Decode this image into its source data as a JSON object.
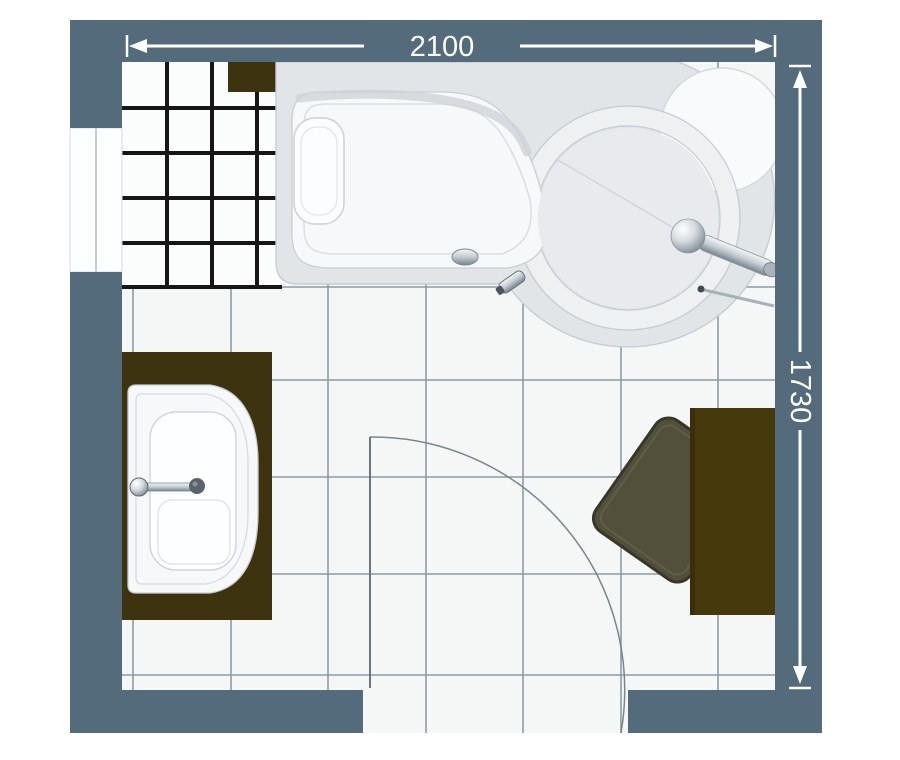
{
  "title": "Bathroom floor plan",
  "dimensions": {
    "width_label": "2100",
    "height_label": "1730"
  },
  "colors": {
    "wall": "#546b7c",
    "floor_tile": "#f5f7f7",
    "floor_grout": "#8a9ba7",
    "splash_tile": "#fbfdfd",
    "splash_grout": "#161616",
    "counter_brown": "#3d330e",
    "cabinet_brown": "#46390c",
    "mat_olive": "#52503a",
    "bath_deck": "#e2e5e7",
    "bath_ring": "#eef0f2",
    "bath_inner": "#e8eaed",
    "bath_white": "#f6f8f9",
    "outline_gray": "#c6cdd3",
    "dimension_white": "#ffffff"
  },
  "fixtures": {
    "bath": "corner-shower-bath",
    "washbasin": "washbasin-on-counter",
    "shelf": "wall-shelf",
    "cabinet": "side-cabinet",
    "mat": "bath-mat",
    "door": "door-swing",
    "window": "window-recess"
  }
}
